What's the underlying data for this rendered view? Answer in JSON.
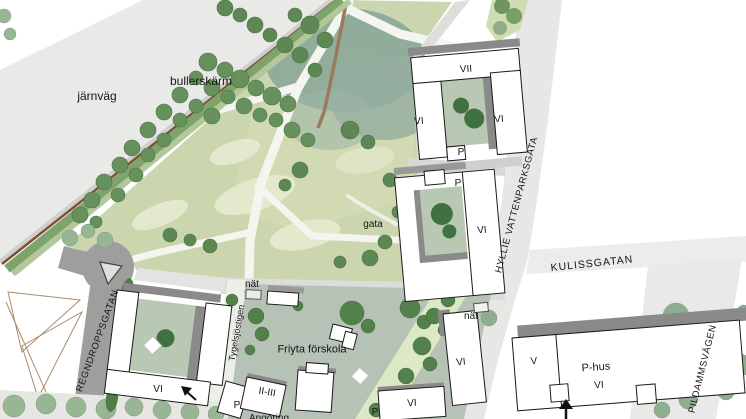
{
  "map": {
    "type": "architectural site plan",
    "labels": {
      "jarnvag": "järnväg",
      "bullerskarm": "bullerskärm",
      "hyllie_vattenparksgata": "HYLLIE VATTENPARKSGATA",
      "kulissgatan": "KULISSGATAN",
      "regndroppsgatan": "REGNDROPPSGATAN",
      "pildammsvagen": "PILDAMMSVÄGEN",
      "tygelsjostigen": "Tygelsjöstigen",
      "friyta_forskola": "Friyta förskola",
      "gata": "gata",
      "nat": "nät",
      "angoring": "Angöring"
    },
    "buildings": {
      "vii": "VII",
      "vi": "VI",
      "v": "V",
      "p": "P",
      "p_hus": "P-hus",
      "ii_iii": "II-III"
    },
    "palette": {
      "park_green": "#ccd6ae",
      "dense_vegetation_teal": "#8ca79a",
      "tree_green": "#67915c",
      "street_tree_sage": "#98b694",
      "railway_gray": "#e9e9e7",
      "street_light_gray": "#e7e7e5",
      "street_dark_gray": "#9e9e9c",
      "courtyard_green": "#b9c8b2",
      "preschool_green": "#b6c2b5",
      "path_pale_green": "#dde8c6",
      "noise_barrier_brown": "#7d4f33",
      "building_fill": "#ffffff",
      "outline_black": "#1a1a1a",
      "shadow_gray": "#8a8a8a"
    }
  }
}
